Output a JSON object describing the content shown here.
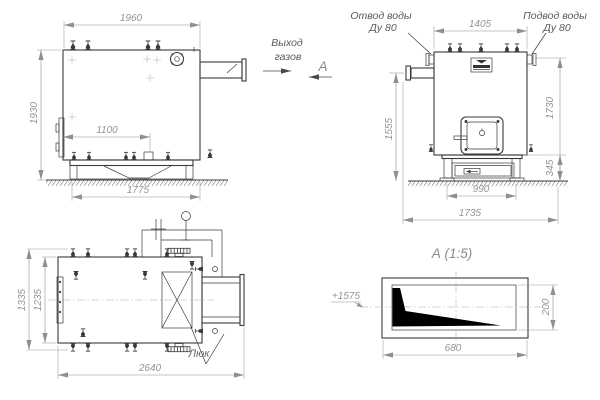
{
  "colors": {
    "line": "#3a3a3a",
    "dimension": "#949494",
    "section_fill": "#000000",
    "background": "#ffffff"
  },
  "front_view": {
    "dim_top": "1960",
    "dim_left": "1930",
    "dim_inner": "1100",
    "dim_base": "1775"
  },
  "gas_outlet": {
    "line1": "Выход",
    "line2": "газов"
  },
  "view_marker": {
    "label": "А"
  },
  "side_view": {
    "outlet_label": {
      "line1": "Отвод воды",
      "line2": "Ду 80"
    },
    "inlet_label": {
      "line1": "Подвод воды",
      "line2": "Ду 80"
    },
    "dim_top": "1405",
    "dim_left": "1555",
    "dim_right": "1730",
    "dim_base_height": "345",
    "dim_base_width": "990",
    "dim_footprint": "1735"
  },
  "plan_view": {
    "dim_outer": "1335",
    "dim_inner": "1235",
    "dim_length": "2640",
    "hatch_label": "Люк"
  },
  "section_view": {
    "title": "А  (1:5)",
    "elevation": "+1575",
    "dim_height": "200",
    "dim_width": "680"
  }
}
